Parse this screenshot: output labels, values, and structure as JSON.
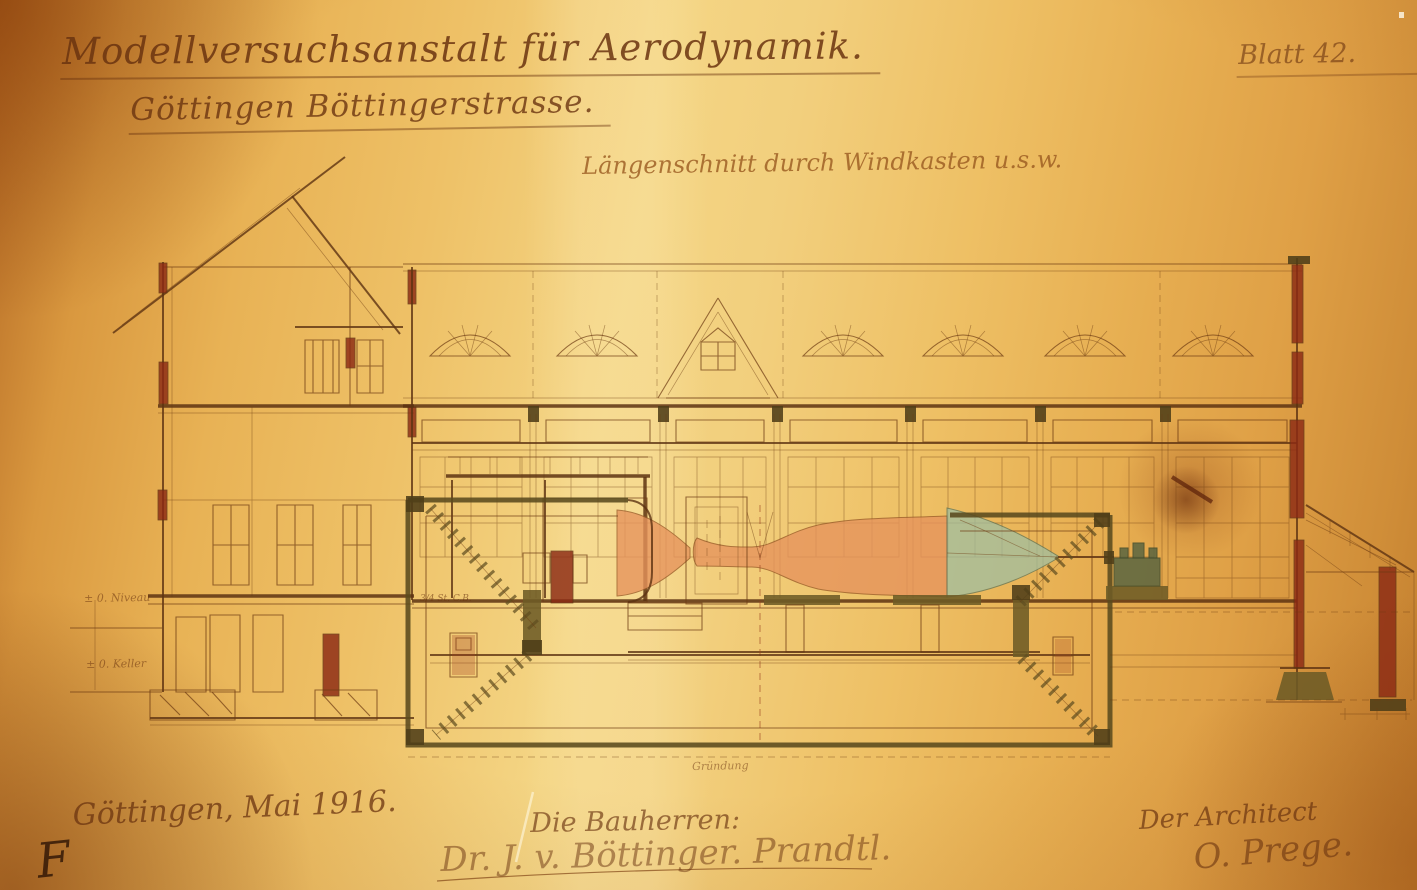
{
  "sheet": {
    "title_line1": "Modellversuchsanstalt für Aerodynamik.",
    "title_line2": "Göttingen Böttingerstrasse.",
    "sheet_number": "Blatt 42.",
    "drawing_caption": "Längenschnitt durch Windkasten u.s.w.",
    "place_date": "Göttingen, Mai 1916.",
    "corner_mark": "F"
  },
  "signatures": {
    "clients_label": "Die Bauherren:",
    "clients_signature": "Dr. J. v. Böttinger.  Prandtl.",
    "architect_label": "Der Architect",
    "architect_signature": "O. Prege."
  },
  "annotations": {
    "level_ground": "± 0. Niveau",
    "level_basement": "± 0. Keller",
    "masonry_note": "3/4 St. C.B.",
    "foundation_note": "Gründung"
  },
  "colors": {
    "paper": "#ecc06a",
    "ink": "#6e3b12",
    "masonry_red": "#8c2a14",
    "tunnel_salmon": "#e6935c",
    "fan_teal": "#9dbfa4",
    "duct_olive": "#5f4d20"
  }
}
